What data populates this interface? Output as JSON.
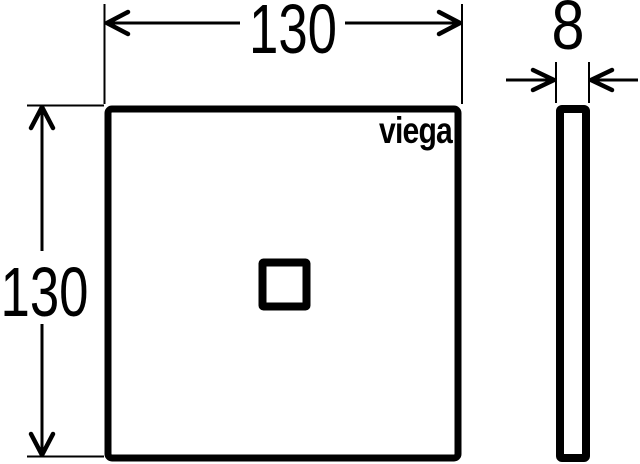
{
  "drawing": {
    "title": "Viega square plate technical drawing, front and side view",
    "brand_logo": "viega",
    "views": {
      "front": {
        "width_label": "130",
        "height_label": "130"
      },
      "side": {
        "thickness_label": "8"
      }
    },
    "colors": {
      "line": "#000000",
      "background": "#ffffff"
    }
  }
}
